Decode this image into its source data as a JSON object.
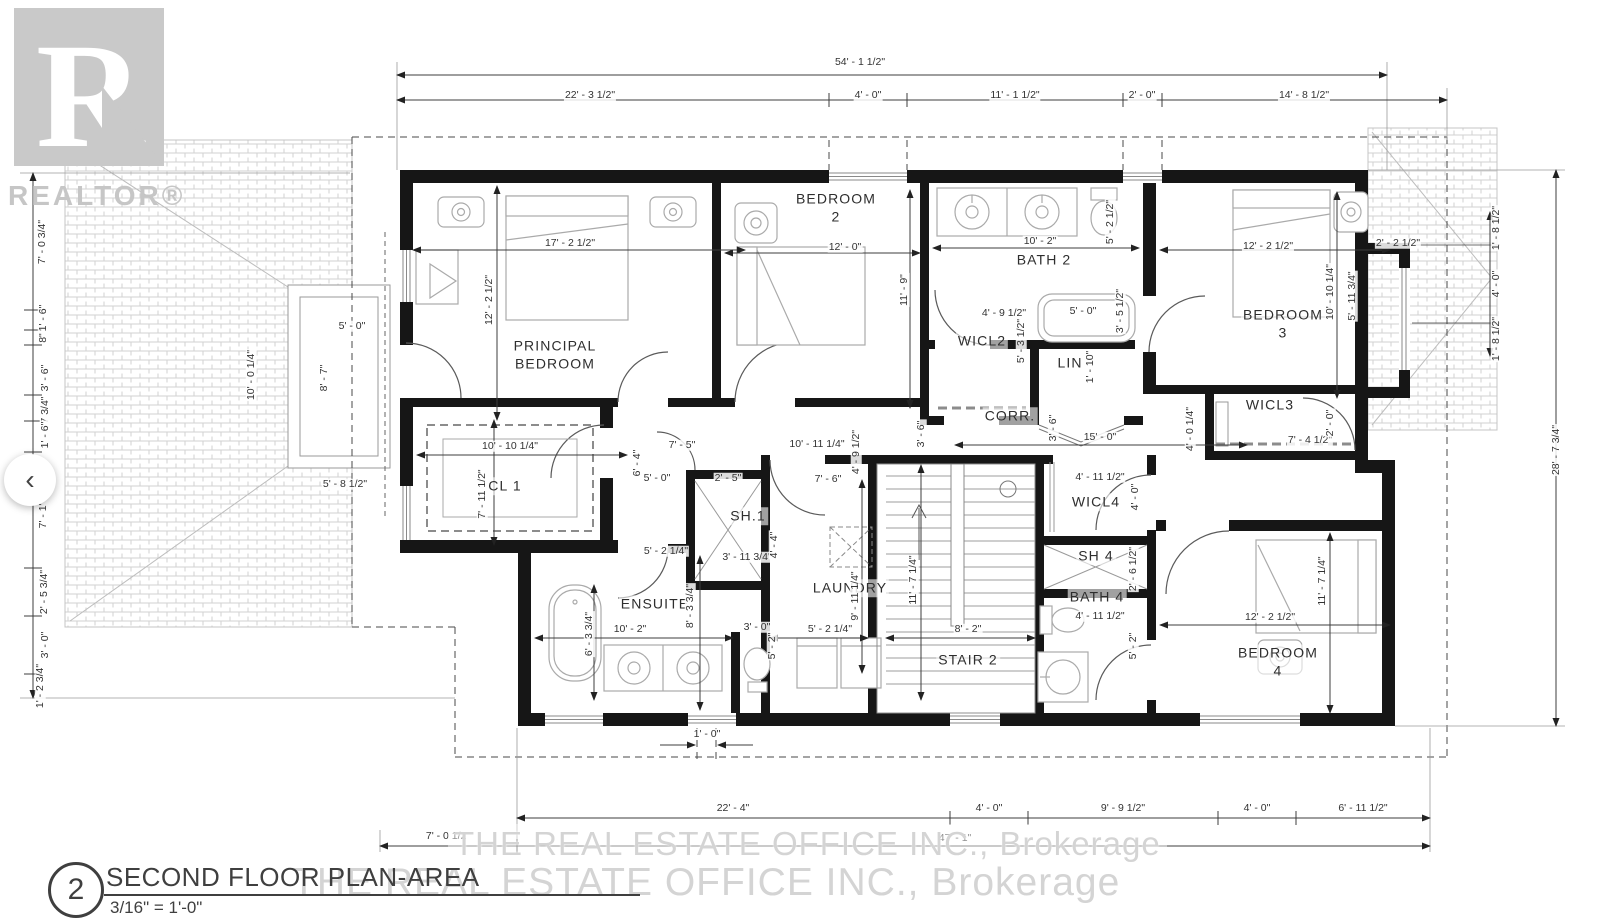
{
  "branding": {
    "logo_letter": "R",
    "wordmark": "REALTOR®"
  },
  "watermarks": {
    "line1": "THE REAL ESTATE OFFICE INC., Brokerage",
    "line2": "THE REAL ESTATE OFFICE INC., Brokerage"
  },
  "title_block": {
    "sheet_number": "2",
    "title": "SECOND FLOOR PLAN-AREA",
    "scale": "3/16\" = 1'-0\""
  },
  "nav": {
    "prev": "‹"
  },
  "colors": {
    "wall": "#161616",
    "dim_text": "#333333",
    "furniture_line": "#aaaaaa",
    "watermark_gray": "#d4d4d4",
    "logo_gray": "#c9c9c9"
  },
  "rooms": [
    {
      "id": "principal-bedroom",
      "label": "PRINCIPAL\nBEDROOM",
      "x": 555,
      "y": 355
    },
    {
      "id": "bedroom-2",
      "label": "BEDROOM\n2",
      "x": 836,
      "y": 208
    },
    {
      "id": "bath-2",
      "label": "BATH 2",
      "x": 1044,
      "y": 260
    },
    {
      "id": "wicl2",
      "label": "WICL2",
      "x": 982,
      "y": 341
    },
    {
      "id": "lin",
      "label": "LIN",
      "x": 1070,
      "y": 363
    },
    {
      "id": "corr",
      "label": "CORR.",
      "x": 1010,
      "y": 416
    },
    {
      "id": "bedroom-3",
      "label": "BEDROOM\n3",
      "x": 1283,
      "y": 324
    },
    {
      "id": "wicl3",
      "label": "WICL3",
      "x": 1270,
      "y": 405
    },
    {
      "id": "cl-1",
      "label": "CL 1",
      "x": 505,
      "y": 486
    },
    {
      "id": "sh-1",
      "label": "SH.1",
      "x": 748,
      "y": 516
    },
    {
      "id": "ensuite",
      "label": "ENSUITE",
      "x": 655,
      "y": 604
    },
    {
      "id": "laundry",
      "label": "LAUNDRY",
      "x": 850,
      "y": 588
    },
    {
      "id": "stair-2",
      "label": "STAIR 2",
      "x": 968,
      "y": 660
    },
    {
      "id": "wicl4",
      "label": "WICL4",
      "x": 1096,
      "y": 502
    },
    {
      "id": "sh-4",
      "label": "SH 4",
      "x": 1096,
      "y": 556
    },
    {
      "id": "bath-4",
      "label": "BATH 4",
      "x": 1097,
      "y": 597
    },
    {
      "id": "bedroom-4",
      "label": "BEDROOM\n4",
      "x": 1278,
      "y": 662
    }
  ],
  "dimensions": [
    {
      "t": "54' - 1 1/2\"",
      "x": 860,
      "y": 62
    },
    {
      "t": "22' - 3 1/2\"",
      "x": 590,
      "y": 95
    },
    {
      "t": "4' - 0\"",
      "x": 868,
      "y": 95
    },
    {
      "t": "11' - 1 1/2\"",
      "x": 1015,
      "y": 95
    },
    {
      "t": "2' - 0\"",
      "x": 1142,
      "y": 95
    },
    {
      "t": "14' - 8 1/2\"",
      "x": 1304,
      "y": 95
    },
    {
      "t": "17' - 2 1/2\"",
      "x": 570,
      "y": 243
    },
    {
      "t": "12' - 2 1/2\"",
      "x": 489,
      "y": 300,
      "r": -90
    },
    {
      "t": "12' - 0\"",
      "x": 845,
      "y": 247
    },
    {
      "t": "11' - 9\"",
      "x": 904,
      "y": 290,
      "r": -90
    },
    {
      "t": "10' - 2\"",
      "x": 1040,
      "y": 241
    },
    {
      "t": "5' - 2 1/2\"",
      "x": 1110,
      "y": 222,
      "r": -90
    },
    {
      "t": "5' - 0\"",
      "x": 1083,
      "y": 311
    },
    {
      "t": "3' - 5 1/2\"",
      "x": 1120,
      "y": 311,
      "r": -90
    },
    {
      "t": "4' - 9 1/2\"",
      "x": 1004,
      "y": 313
    },
    {
      "t": "5' - 3 1/2\"",
      "x": 1021,
      "y": 341,
      "r": -90
    },
    {
      "t": "1' - 10\"",
      "x": 1090,
      "y": 367,
      "r": -90
    },
    {
      "t": "12' - 2 1/2\"",
      "x": 1268,
      "y": 246
    },
    {
      "t": "2' - 2 1/2\"",
      "x": 1398,
      "y": 243
    },
    {
      "t": "10' - 10 1/4\"",
      "x": 1330,
      "y": 292,
      "r": -90
    },
    {
      "t": "5' - 11 3/4\"",
      "x": 1352,
      "y": 296,
      "r": -90
    },
    {
      "t": "7' - 4 1/2\"",
      "x": 1310,
      "y": 440
    },
    {
      "t": "2' - 0\"",
      "x": 1330,
      "y": 423,
      "r": -90
    },
    {
      "t": "4' - 0 1/4\"",
      "x": 1190,
      "y": 429,
      "r": -90
    },
    {
      "t": "15' - 0\"",
      "x": 1100,
      "y": 437
    },
    {
      "t": "3' - 6\"",
      "x": 1053,
      "y": 428,
      "r": -90
    },
    {
      "t": "3' - 6\"",
      "x": 921,
      "y": 434,
      "r": -90
    },
    {
      "t": "10' - 11 1/4\"",
      "x": 817,
      "y": 444
    },
    {
      "t": "4' - 9 1/2\"",
      "x": 856,
      "y": 452,
      "r": -90
    },
    {
      "t": "7' - 6\"",
      "x": 828,
      "y": 479
    },
    {
      "t": "7' - 5\"",
      "x": 682,
      "y": 445
    },
    {
      "t": "6' - 4\"",
      "x": 637,
      "y": 463,
      "r": -90
    },
    {
      "t": "5' - 0\"",
      "x": 657,
      "y": 478
    },
    {
      "t": "2' - 5\"",
      "x": 728,
      "y": 478
    },
    {
      "t": "10' - 10 1/4\"",
      "x": 510,
      "y": 446
    },
    {
      "t": "7' - 11 1/2\"",
      "x": 482,
      "y": 494,
      "r": -90
    },
    {
      "t": "5' - 2 1/4\"",
      "x": 666,
      "y": 551
    },
    {
      "t": "3' - 11 3/4\"",
      "x": 747,
      "y": 557
    },
    {
      "t": "4' - 4\"",
      "x": 774,
      "y": 545,
      "r": -90
    },
    {
      "t": "8' - 3 3/4\"",
      "x": 690,
      "y": 606,
      "r": -90
    },
    {
      "t": "6' - 3 3/4\"",
      "x": 589,
      "y": 634,
      "r": -90
    },
    {
      "t": "10' - 2\"",
      "x": 630,
      "y": 629
    },
    {
      "t": "3' - 0\"",
      "x": 757,
      "y": 627
    },
    {
      "t": "5' - 2\"",
      "x": 772,
      "y": 646,
      "r": -90
    },
    {
      "t": "9' - 11 1/4\"",
      "x": 855,
      "y": 596,
      "r": -90
    },
    {
      "t": "5' - 2 1/4\"",
      "x": 830,
      "y": 629
    },
    {
      "t": "11' - 7 1/4\"",
      "x": 913,
      "y": 580,
      "r": -90
    },
    {
      "t": "8' - 2\"",
      "x": 968,
      "y": 629
    },
    {
      "t": "4' - 11 1/2\"",
      "x": 1100,
      "y": 477
    },
    {
      "t": "4' - 0\"",
      "x": 1135,
      "y": 497,
      "r": -90
    },
    {
      "t": "2' - 6 1/2\"",
      "x": 1133,
      "y": 569,
      "r": -90
    },
    {
      "t": "4' - 11 1/2\"",
      "x": 1100,
      "y": 616
    },
    {
      "t": "5' - 2\"",
      "x": 1133,
      "y": 646,
      "r": -90
    },
    {
      "t": "12' - 2 1/2\"",
      "x": 1270,
      "y": 617
    },
    {
      "t": "11' - 7 1/4\"",
      "x": 1322,
      "y": 581,
      "r": -90
    },
    {
      "t": "1' - 8 1/2\"",
      "x": 1496,
      "y": 228,
      "r": -90
    },
    {
      "t": "4' - 0\"",
      "x": 1496,
      "y": 284,
      "r": -90
    },
    {
      "t": "1' - 8 1/2\"",
      "x": 1496,
      "y": 339,
      "r": -90
    },
    {
      "t": "28' - 7 3/4\"",
      "x": 1556,
      "y": 450,
      "r": -90
    },
    {
      "t": "10' - 0 1/4\"",
      "x": 251,
      "y": 375,
      "r": -90
    },
    {
      "t": "5' - 0\"",
      "x": 352,
      "y": 326
    },
    {
      "t": "8' - 7\"",
      "x": 324,
      "y": 378,
      "r": -90
    },
    {
      "t": "5' - 8 1/2\"",
      "x": 345,
      "y": 484
    },
    {
      "t": "7' - 0 3/4\"",
      "x": 42,
      "y": 242,
      "r": -90
    },
    {
      "t": "1' - 6\"",
      "x": 43,
      "y": 318,
      "r": -90
    },
    {
      "t": "8\"",
      "x": 43,
      "y": 338,
      "r": -90
    },
    {
      "t": "3' - 6\"",
      "x": 45,
      "y": 378,
      "r": -90
    },
    {
      "t": "7 3/4\"",
      "x": 45,
      "y": 410,
      "r": -90
    },
    {
      "t": "1' - 6\"",
      "x": 45,
      "y": 435,
      "r": -90
    },
    {
      "t": "7' - 1\"",
      "x": 43,
      "y": 515,
      "r": -90
    },
    {
      "t": "2' - 5 3/4\"",
      "x": 44,
      "y": 592,
      "r": -90
    },
    {
      "t": "3' - 0\"",
      "x": 45,
      "y": 645,
      "r": -90
    },
    {
      "t": "1' - 2 3/4\"",
      "x": 40,
      "y": 686,
      "r": -90
    },
    {
      "t": "1' - 0\"",
      "x": 707,
      "y": 734
    },
    {
      "t": "22' - 4\"",
      "x": 733,
      "y": 808
    },
    {
      "t": "4' - 0\"",
      "x": 989,
      "y": 808
    },
    {
      "t": "9' - 9 1/2\"",
      "x": 1123,
      "y": 808
    },
    {
      "t": "4' - 0\"",
      "x": 1257,
      "y": 808
    },
    {
      "t": "6' - 11 1/2\"",
      "x": 1363,
      "y": 808
    },
    {
      "t": "7' - 0 1/2\"",
      "x": 448,
      "y": 836
    },
    {
      "t": "47' - 1\"",
      "x": 955,
      "y": 838
    }
  ]
}
